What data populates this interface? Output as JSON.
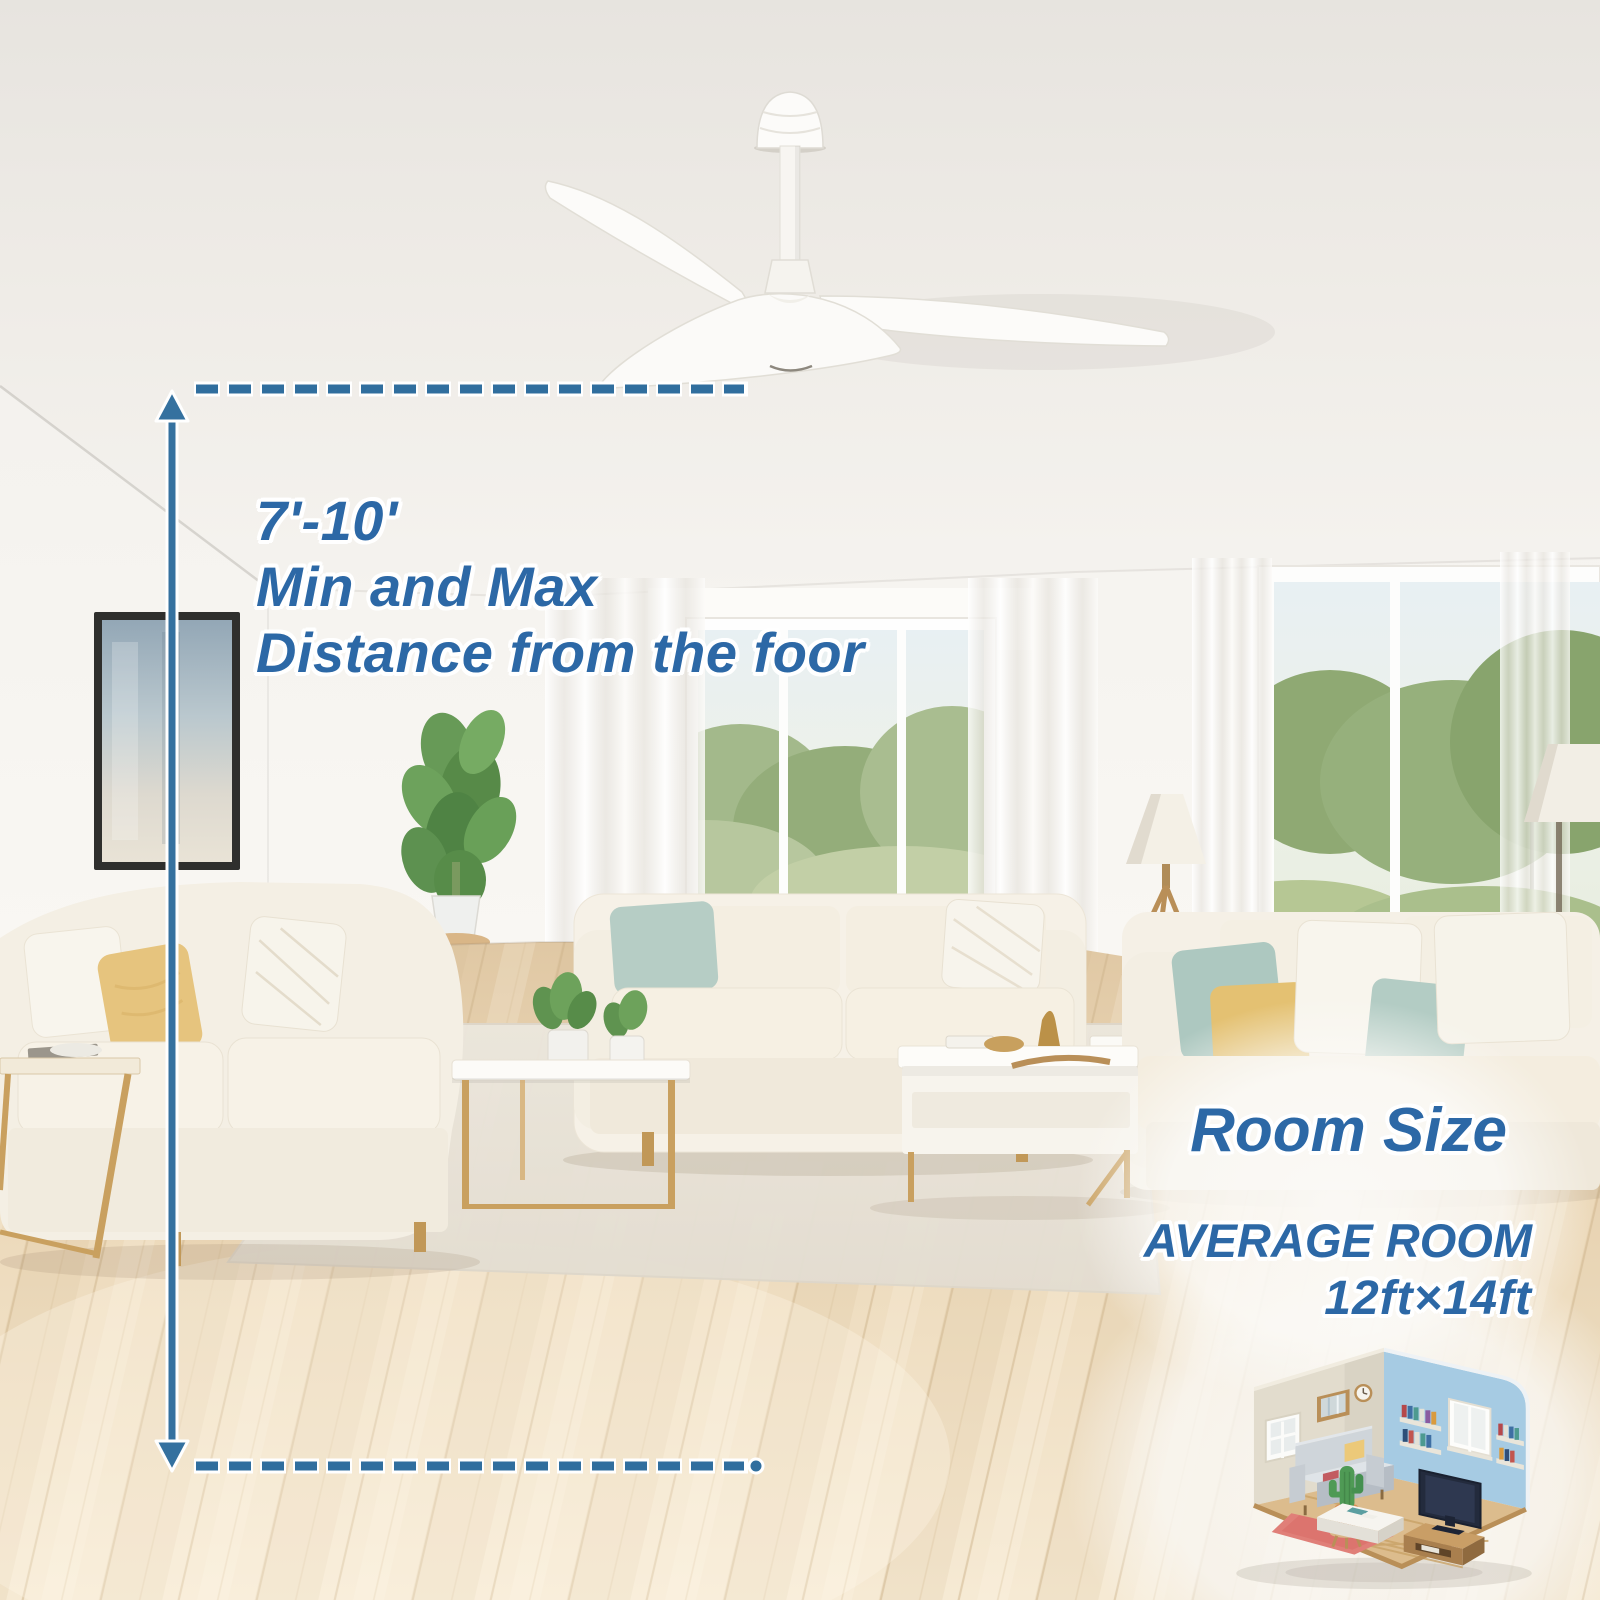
{
  "annotations": {
    "mounting_height": {
      "range": "7'-10'",
      "line2": "Min and Max",
      "line3": "Distance from the foor"
    },
    "room_size": {
      "heading": "Room Size",
      "subtitle": "AVERAGE ROOM",
      "dimensions": "12ft×14ft"
    }
  },
  "icons": {
    "fan": "ceiling-fan",
    "measure_arrow": "vertical-double-arrow",
    "guide_lines": "dashed-guide-line",
    "room_thumbnail": "isometric-living-room"
  },
  "colors": {
    "annotation_blue": "#2c68a6",
    "measure_blue": "#306e9e",
    "iso_wall_left": "#e2dccd",
    "iso_wall_right": "#a6cbe3"
  }
}
